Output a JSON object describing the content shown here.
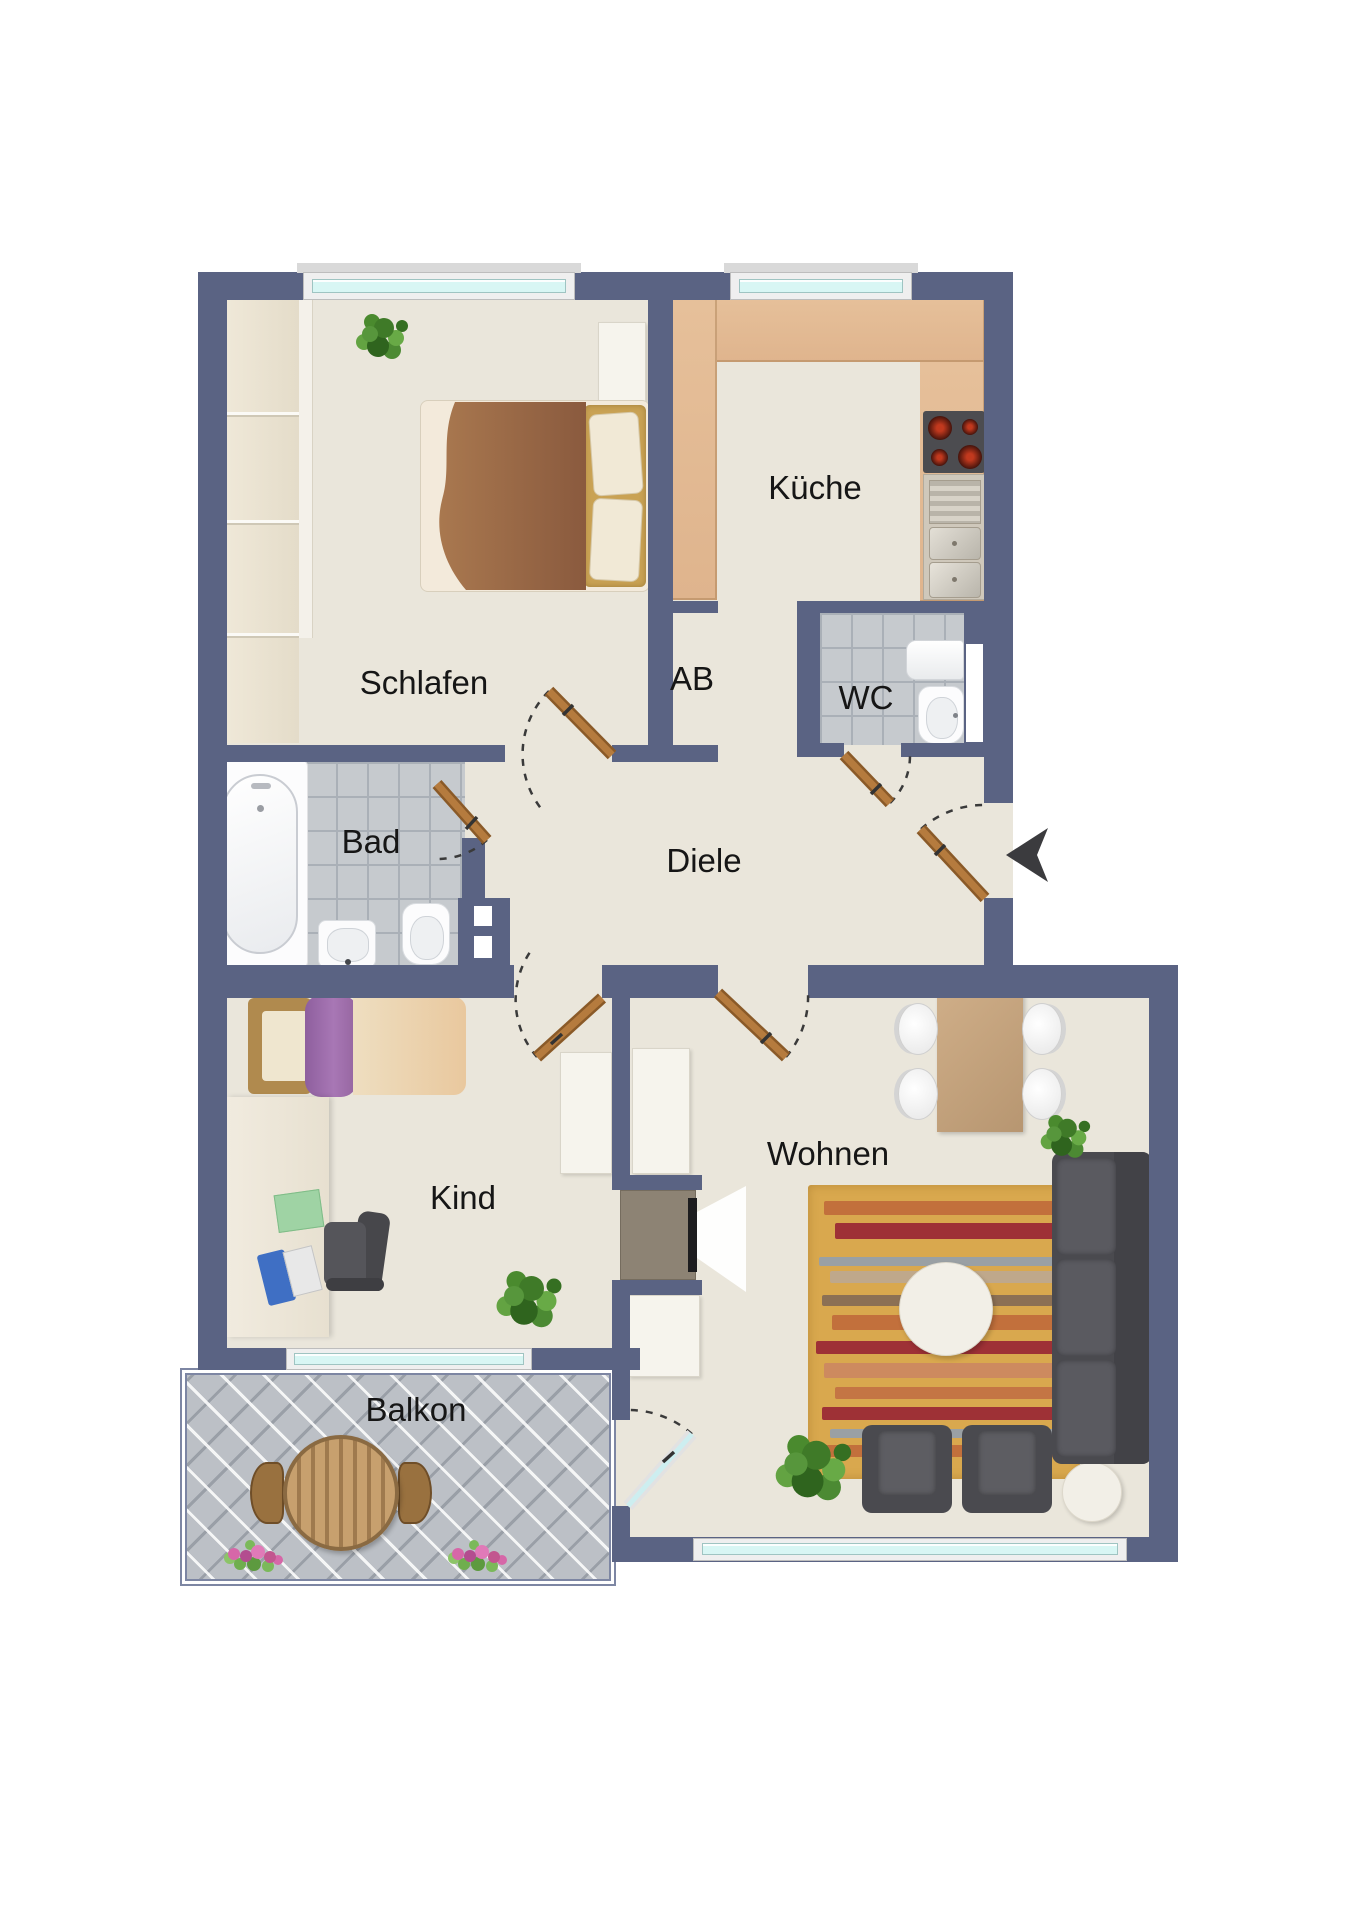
{
  "floorplan": {
    "rooms": [
      {
        "id": "schlafen",
        "label": "Schlafen"
      },
      {
        "id": "kueche",
        "label": "Küche"
      },
      {
        "id": "ab",
        "label": "AB"
      },
      {
        "id": "wc",
        "label": "WC"
      },
      {
        "id": "bad",
        "label": "Bad"
      },
      {
        "id": "diele",
        "label": "Diele"
      },
      {
        "id": "kind",
        "label": "Kind"
      },
      {
        "id": "wohnen",
        "label": "Wohnen"
      },
      {
        "id": "balkon",
        "label": "Balkon"
      }
    ],
    "colors": {
      "wall": "#5a6383",
      "floor": "#eae6db",
      "counter": "#dfb48d",
      "tile": "#c6cace",
      "tile_line": "#aab0b7",
      "balcony_tile": "#bcc0c6",
      "glass": "#d8f6f4",
      "window_frame": "#efefef",
      "door": "#b57b3e",
      "door_edge": "#8a5a28",
      "rug": "#d9a84e",
      "dark_furniture": "#515156",
      "white_furniture": "#f6f4ed",
      "white_furniture_border": "#d9d5c9",
      "label": "#161616",
      "arrow": "#3b3b3e",
      "wood": "#c09a68"
    },
    "rug": {
      "stripes": [
        {
          "t": 16,
          "h": 14,
          "l": 6,
          "w": 88,
          "c": "#c2703c"
        },
        {
          "t": 38,
          "h": 16,
          "l": 10,
          "w": 86,
          "c": "#9e3136"
        },
        {
          "t": 72,
          "h": 9,
          "l": 4,
          "w": 92,
          "c": "#9aa0a4"
        },
        {
          "t": 86,
          "h": 12,
          "l": 8,
          "w": 88,
          "c": "#bfa88b"
        },
        {
          "t": 110,
          "h": 11,
          "l": 5,
          "w": 85,
          "c": "#8c7054"
        },
        {
          "t": 130,
          "h": 15,
          "l": 9,
          "w": 87,
          "c": "#c2703c"
        },
        {
          "t": 156,
          "h": 13,
          "l": 3,
          "w": 94,
          "c": "#9e3136"
        },
        {
          "t": 178,
          "h": 15,
          "l": 6,
          "w": 90,
          "c": "#cd8a5f"
        },
        {
          "t": 202,
          "h": 12,
          "l": 10,
          "w": 86,
          "c": "#c47544"
        },
        {
          "t": 222,
          "h": 13,
          "l": 5,
          "w": 88,
          "c": "#9e3136"
        },
        {
          "t": 244,
          "h": 9,
          "l": 8,
          "w": 86,
          "c": "#9aa0a4"
        },
        {
          "t": 260,
          "h": 12,
          "l": 4,
          "w": 90,
          "c": "#c2703c"
        }
      ]
    }
  }
}
